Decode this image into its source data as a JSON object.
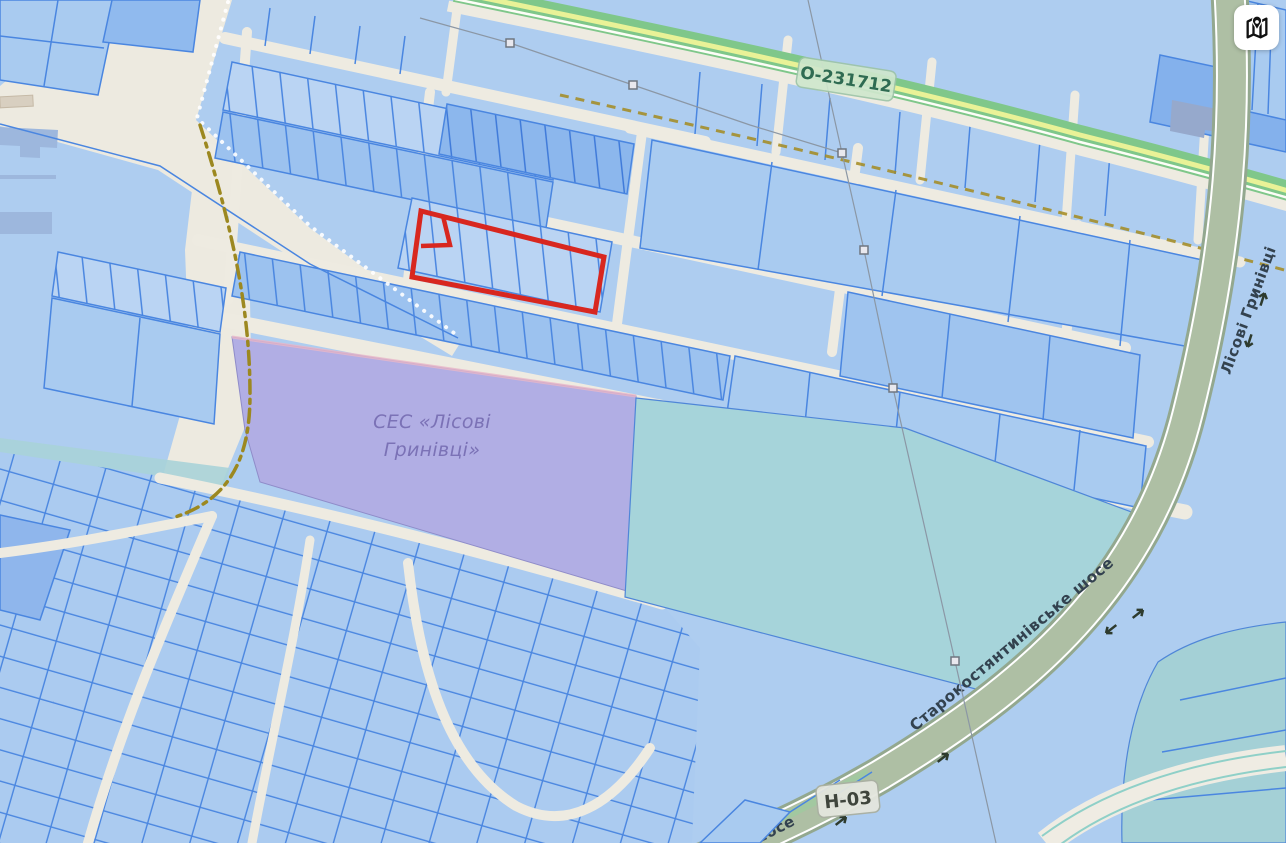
{
  "map": {
    "roads": {
      "top_road_badge": "О-231712",
      "right_road_label": "Лісові Гринівці",
      "diagonal_road_label": "Старокостянтинівське шосе",
      "diagonal_road_label_fragment": "шосе",
      "highway_badge": "Н-03"
    },
    "areas": {
      "ses_label_line1": "СЕС «Лісові",
      "ses_label_line2": "Гринівці»"
    },
    "controls": {
      "map_button_icon": "map-with-pin-icon"
    }
  },
  "colors": {
    "selection": "#d8271f",
    "parcel_fill_light": "#bad4f3",
    "parcel_fill_medium": "#9cc2ef",
    "parcel_fill_dark": "#8cb7ed",
    "parcel_border": "#4a86e0",
    "base_land": "#edeae0",
    "base_parcels": "#aecdf0",
    "ses_area": "#b1aee4",
    "big_field": "#a6d4da",
    "green_road": "#7fc78a",
    "gray_road": "#9db29a",
    "boundary_dash": "#9c8820"
  }
}
